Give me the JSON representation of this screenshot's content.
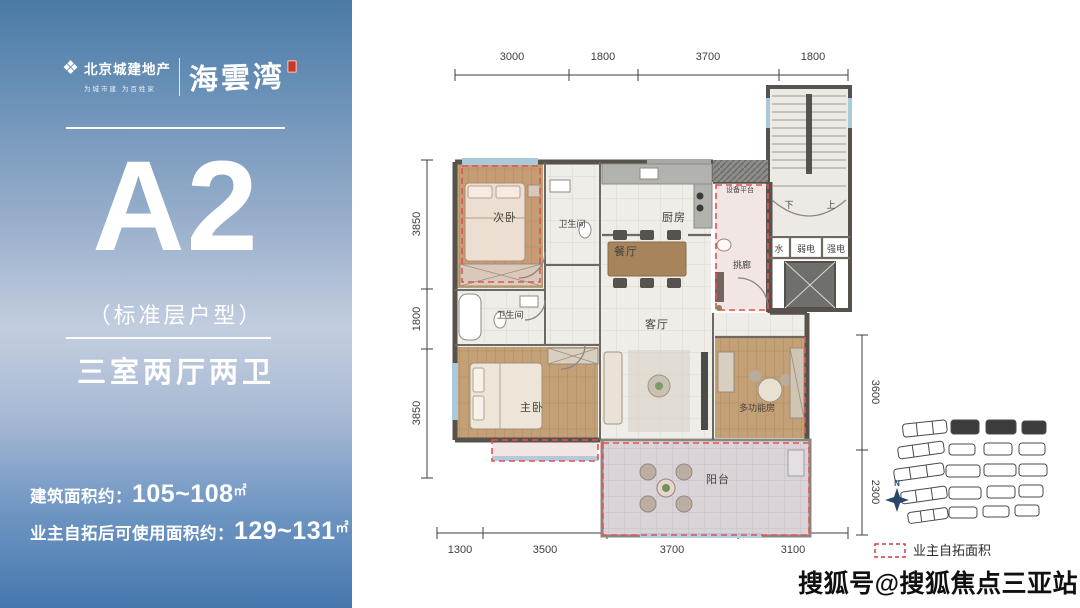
{
  "panel": {
    "brand": {
      "company": "北京城建地产",
      "slogan": "为城市建 为百姓家",
      "project": "海雲湾"
    },
    "unit": {
      "code": "A2",
      "subtitle": "（标准层户型）",
      "layout": "三室两厅两卫"
    },
    "areas": {
      "built_label": "建筑面积约：",
      "built_value": "105~108",
      "usable_label": "业主自拓后可使用面积约：",
      "usable_value": "129~131",
      "unit_suffix": "㎡"
    }
  },
  "plan": {
    "dims": {
      "top": [
        "3000",
        "1800",
        "3700",
        "1800"
      ],
      "bottom": [
        "1300",
        "3500",
        "3700",
        "3100"
      ],
      "left": [
        "3850",
        "1800",
        "3850"
      ],
      "right": [
        "3600",
        "2300"
      ]
    },
    "rooms": {
      "bedroom2": "次卧",
      "bath_upper": "卫生间",
      "kitchen": "厨房",
      "dining": "餐厅",
      "bath_lower": "卫生间",
      "living": "客厅",
      "master_bedroom": "主卧",
      "multi_room": "多功能房",
      "balcony": "阳台",
      "corridor": "挑廊",
      "equipment": "设备平台",
      "stair_down": "下",
      "stair_up": "上",
      "water": "水",
      "weak_power": "弱电",
      "strong_power": "强电"
    },
    "compass_label": "N"
  },
  "legend": {
    "self_expand": "业主自拓面积"
  },
  "watermark": "搜狐号@搜狐焦点三亚站"
}
